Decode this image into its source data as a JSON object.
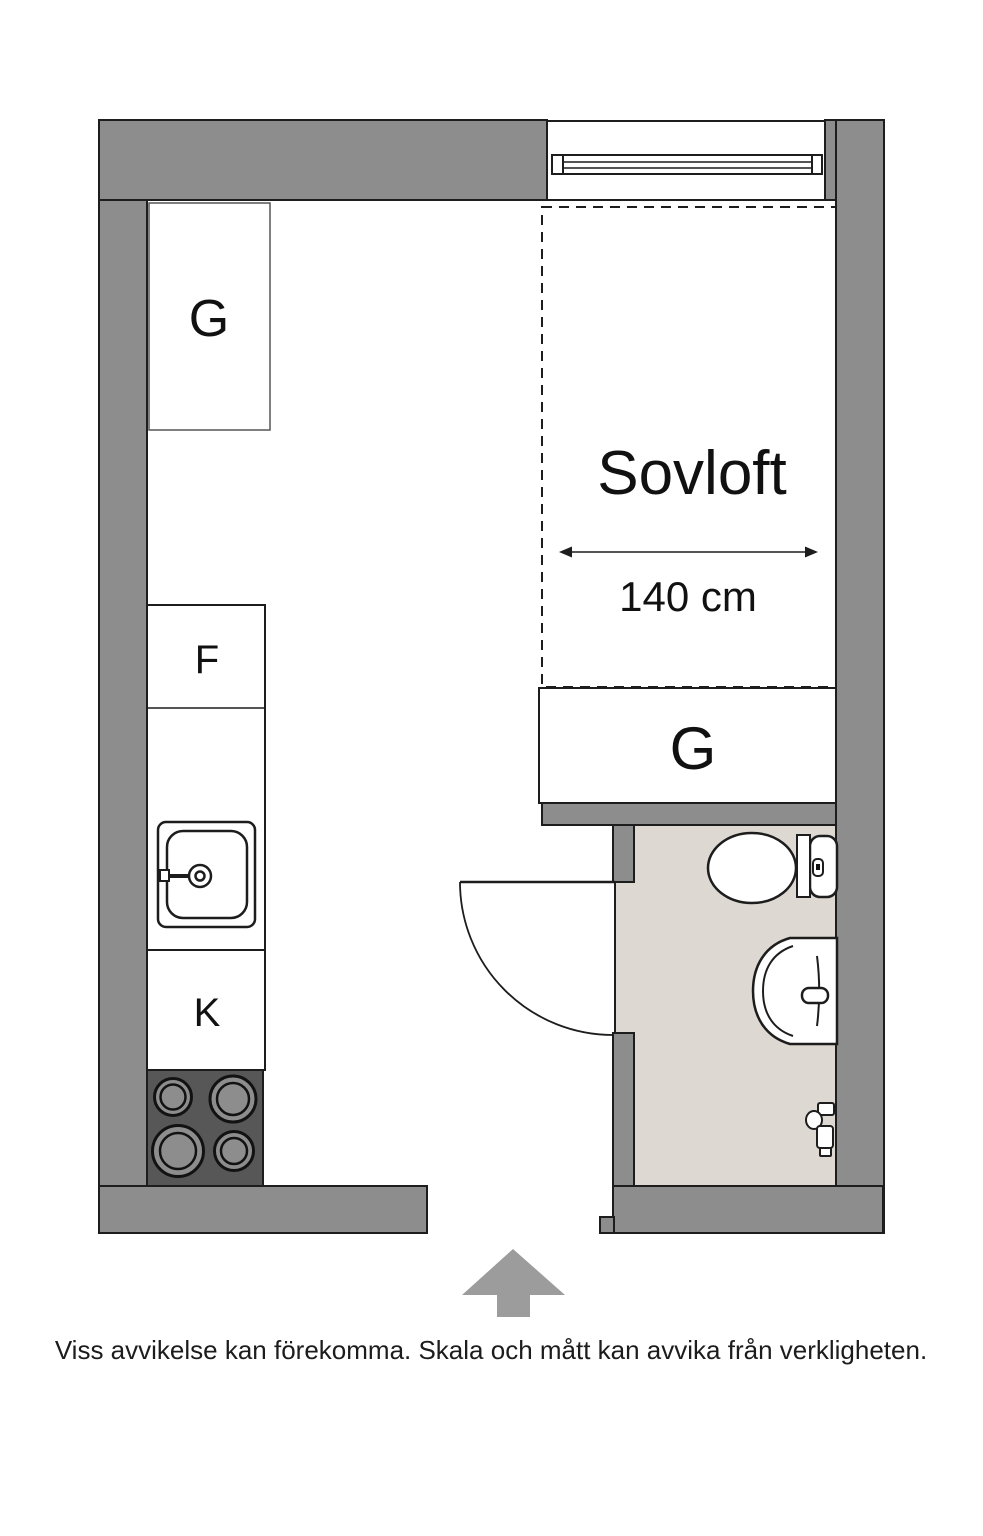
{
  "floorplan": {
    "loft": {
      "label": "Sovloft",
      "width_dimension": "140 cm"
    },
    "fixtures": {
      "closet_top_label": "G",
      "closet_loft_label": "G",
      "fridge_label": "F",
      "stove_label": "K"
    },
    "disclaimer": "Viss avvikelse kan förekomma. Skala och mått kan avvika från verkligheten.",
    "colors": {
      "wall": "#8d8d8d",
      "ink": "#1d1d1d",
      "bathroom_floor": "#ddd8d1",
      "stove": "#575757",
      "burner": "#8d8d8d",
      "arrow": "#9c9c9c"
    }
  }
}
